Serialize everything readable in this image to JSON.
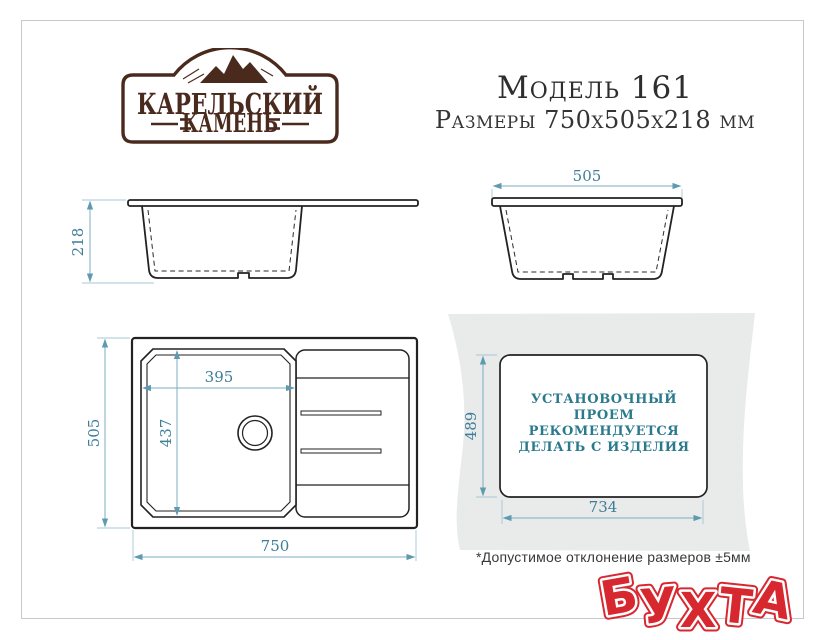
{
  "brand": {
    "line1": "КАРЕЛЬСКИЙ",
    "line2": "КАМЕНЬ"
  },
  "header": {
    "model": "Модель 161",
    "dimensions": "Размеры 750х505х218 мм"
  },
  "views": {
    "front_section": {
      "height_label": "218"
    },
    "side_section": {
      "width_label": "505"
    },
    "top_view": {
      "overall_width_label": "750",
      "overall_depth_label": "505",
      "bowl_width_label": "395",
      "bowl_depth_label": "437"
    },
    "install_cutout": {
      "width_label": "734",
      "depth_label": "489",
      "note_lines": [
        "УСТАНОВОЧНЫЙ",
        "ПРОЕМ",
        "РЕКОМЕНДУЕТСЯ",
        "ДЕЛАТЬ С ИЗДЕЛИЯ"
      ]
    }
  },
  "footnote": "*Допустимое отклонение размеров ±5мм",
  "watermark": {
    "text": "БУХТА"
  },
  "colors": {
    "drawing_ink": "#222222",
    "dimension_text": "#3e7e97",
    "dimension_line": "#7badc0",
    "brand_brown": "#4b2a1e",
    "note_teal": "#2a7a8c",
    "watermark_red": "#d7282f",
    "countertop_gray": "#e9eaea",
    "frame_border": "#c7cacb"
  }
}
